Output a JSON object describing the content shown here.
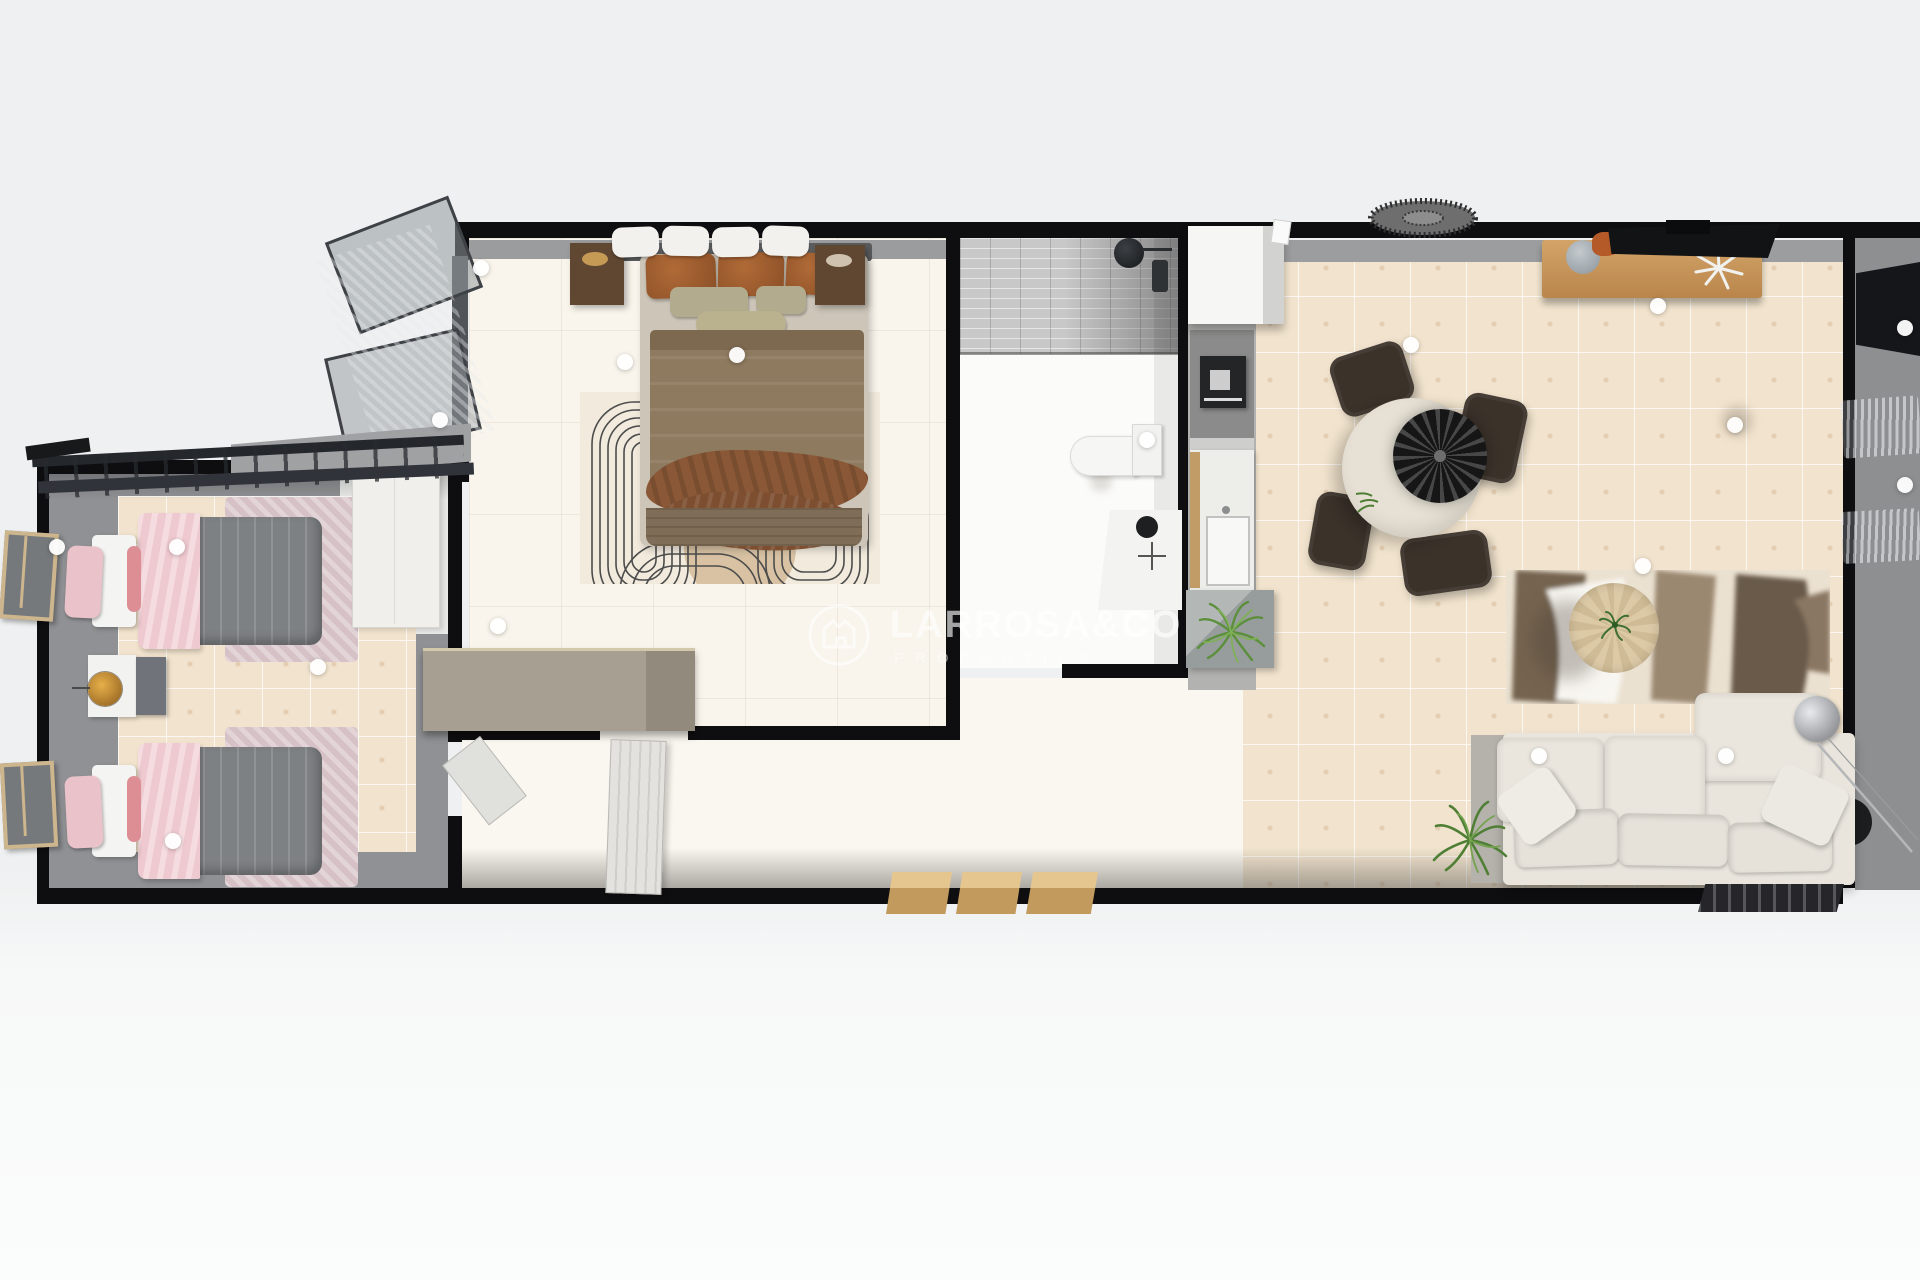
{
  "watermark": {
    "title": "LARROSA&CO",
    "subtitle": "PROPERTIES",
    "logo_icon": "house-crown-circle-icon",
    "text_color": "rgba(255,255,255,0.6)"
  },
  "scene": {
    "view": "top-down 3d floorplan render",
    "background_color": "#eff0f1",
    "wall_color": "#0e0e10",
    "floor_colors": {
      "beige_tile": "#f1e3cd",
      "cream_tile": "#f9f5ec",
      "terrace_gray": "#909194",
      "shower_gray": "#c3c3c3"
    }
  },
  "rooms": [
    {
      "name": "twin-bedroom",
      "furniture": [
        "twin-bed-pink-gray-1",
        "twin-bed-pink-gray-2",
        "nightstand-white",
        "side-table-gray",
        "table-lamp-gold",
        "wardrobe-white",
        "dresser-taupe",
        "casement-window-1",
        "casement-window-2",
        "pergola-slats"
      ]
    },
    {
      "name": "master-bedroom",
      "furniture": [
        "double-bed-brown",
        "headboard-pillows",
        "nightstand-dark-left",
        "nightstand-dark-right",
        "patterned-maze-rug",
        "open-window-with-curtain",
        "door-to-hallway"
      ]
    },
    {
      "name": "bathroom",
      "furniture": [
        "walk-in-shower",
        "shower-head-black",
        "wall-mixer",
        "toilet",
        "vanity-with-black-sink"
      ]
    },
    {
      "name": "kitchen",
      "furniture": [
        "fridge-white",
        "oven-cooktop-black",
        "counter-with-sink",
        "concrete-planter-plant"
      ]
    },
    {
      "name": "living-dining",
      "furniture": [
        "round-dining-table",
        "pendant-disc-lamp",
        "dining-chair-1",
        "dining-chair-2",
        "dining-chair-3",
        "dining-chair-4",
        "rattan-pendant",
        "sideboard-wood",
        "tv-top-wall",
        "tv-right-wall",
        "abstract-area-rug",
        "round-coffee-table",
        "sofa-cream-chaise",
        "floor-lamp-globe",
        "floor-plant",
        "side-table-black",
        "entrance-mat-1",
        "entrance-mat-2",
        "entrance-mat-3",
        "doormat-dark"
      ]
    }
  ],
  "hotspots": {
    "style": "white-dot-marker",
    "points": [
      {
        "x": 57,
        "y": 547
      },
      {
        "x": 177,
        "y": 547
      },
      {
        "x": 173,
        "y": 841
      },
      {
        "x": 318,
        "y": 667
      },
      {
        "x": 481,
        "y": 268
      },
      {
        "x": 440,
        "y": 420
      },
      {
        "x": 625,
        "y": 362
      },
      {
        "x": 737,
        "y": 355
      },
      {
        "x": 498,
        "y": 626
      },
      {
        "x": 1147,
        "y": 440
      },
      {
        "x": 1411,
        "y": 345
      },
      {
        "x": 1658,
        "y": 306
      },
      {
        "x": 1735,
        "y": 425
      },
      {
        "x": 1905,
        "y": 328
      },
      {
        "x": 1905,
        "y": 485
      },
      {
        "x": 1643,
        "y": 566
      },
      {
        "x": 1539,
        "y": 756
      },
      {
        "x": 1726,
        "y": 756
      }
    ]
  }
}
